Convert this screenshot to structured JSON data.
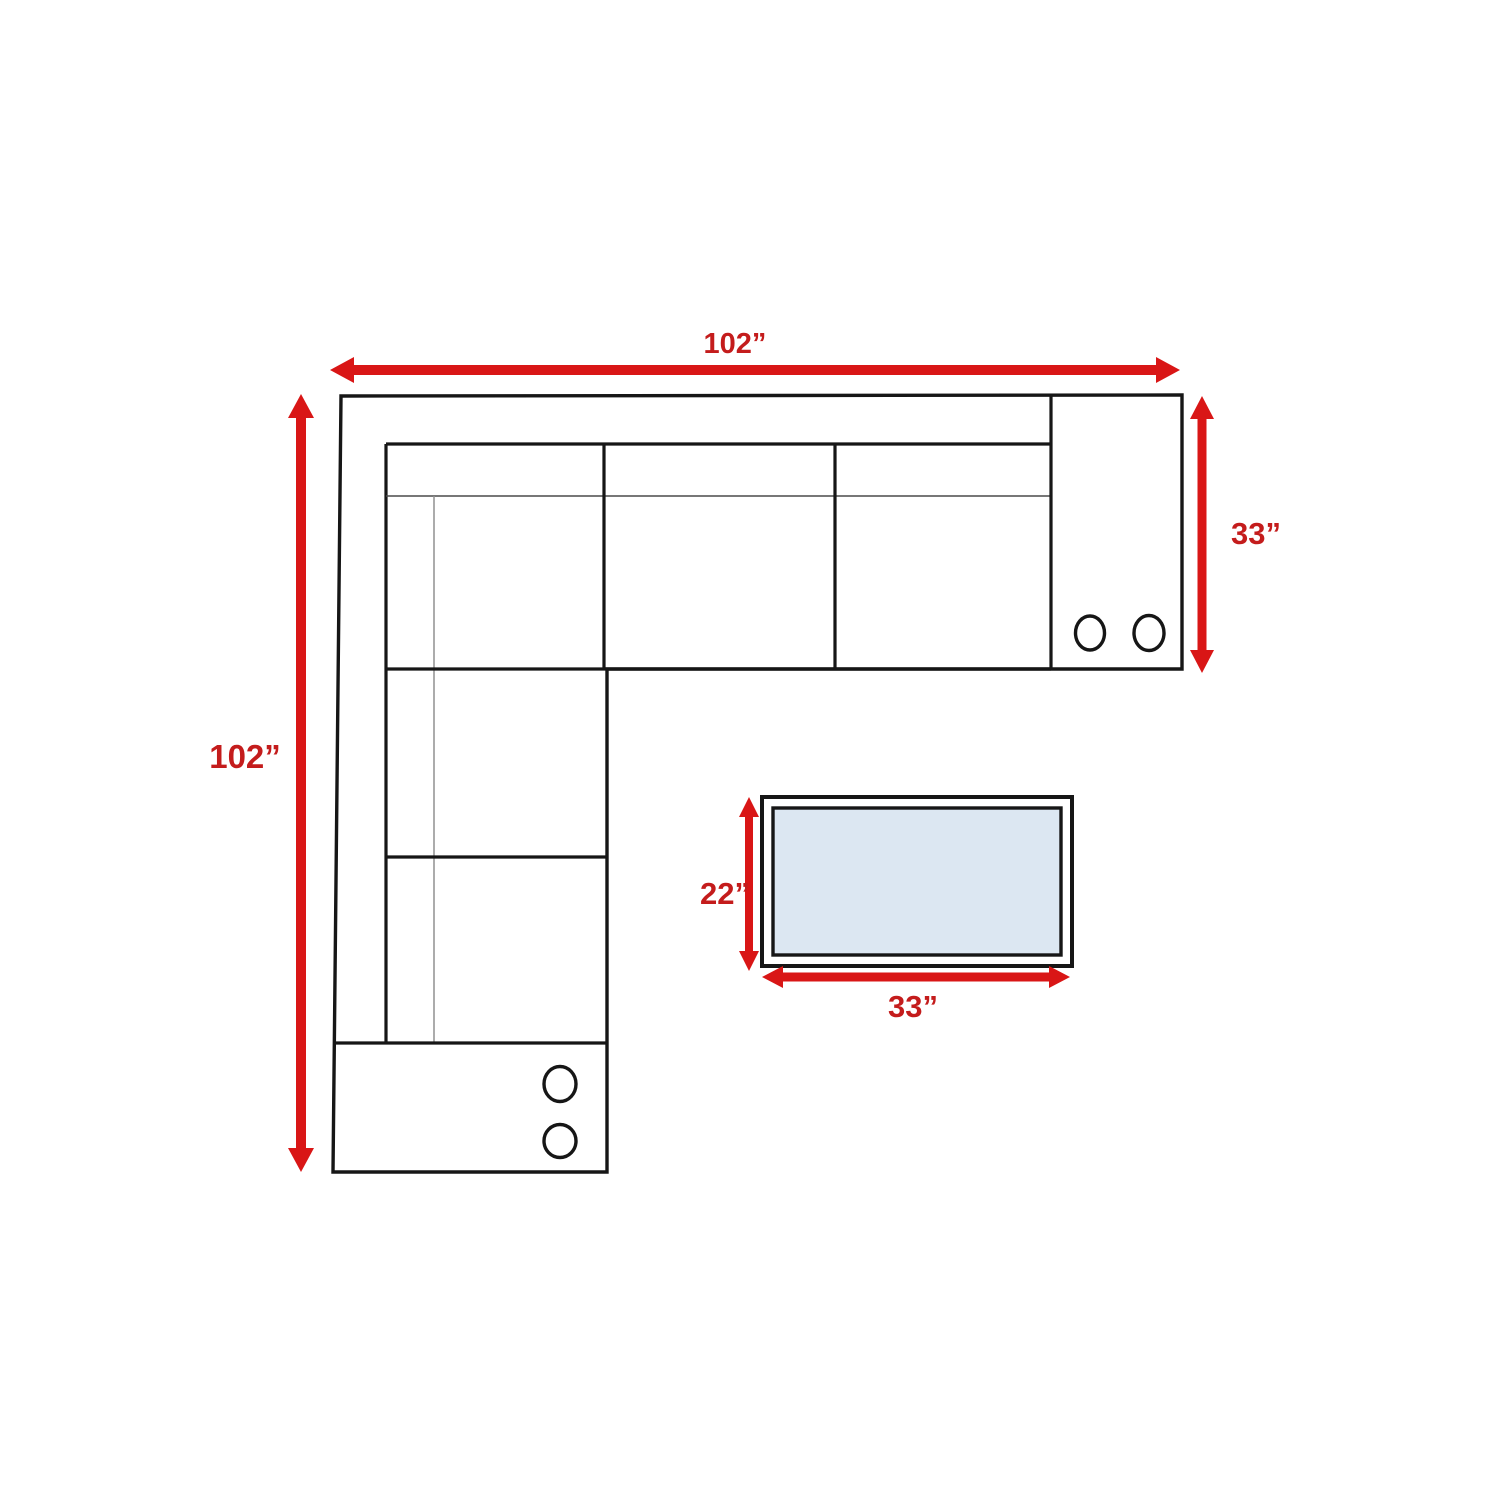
{
  "diagram": {
    "dimensions": {
      "sofa_width": "102”",
      "sofa_depth": "102”",
      "right_section_depth": "33”",
      "table_depth": "22”",
      "table_width": "33”"
    },
    "icons": {
      "cupholders_right_console": 2,
      "cupholders_bottom_console": 2
    },
    "colors": {
      "arrow_red": "#d91616",
      "label_red": "#c41c1c",
      "line_black": "#161616",
      "thin_line_gray": "#909090",
      "table_fill": "#dce7f2",
      "background": "#ffffff"
    }
  }
}
